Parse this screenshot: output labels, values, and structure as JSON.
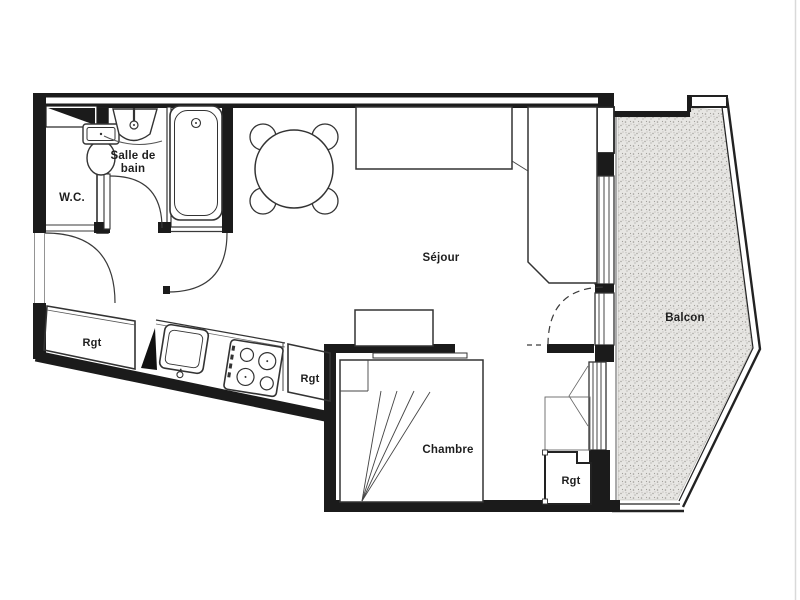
{
  "floor_plan": {
    "type": "apartment-studio-floor-plan",
    "rooms": {
      "wc": {
        "label": "W.C."
      },
      "bathroom": {
        "label_line_1": "Salle de",
        "label_line_2": "bain"
      },
      "living_room": {
        "label": "Séjour"
      },
      "bedroom": {
        "label": "Chambre"
      },
      "balcony": {
        "label": "Balcon"
      }
    },
    "storage": {
      "kitchen_left": {
        "label": "Rgt"
      },
      "kitchen_right": {
        "label": "Rgt"
      },
      "bedroom": {
        "label": "Rgt"
      }
    },
    "colors": {
      "background": "#ffffff",
      "wall": "#1b1b1b",
      "line": "#3a3a3a",
      "balcony_fill": "#e7e6e3",
      "balcony_speckle": "#a09e99",
      "text": "#1e1e1e"
    }
  }
}
